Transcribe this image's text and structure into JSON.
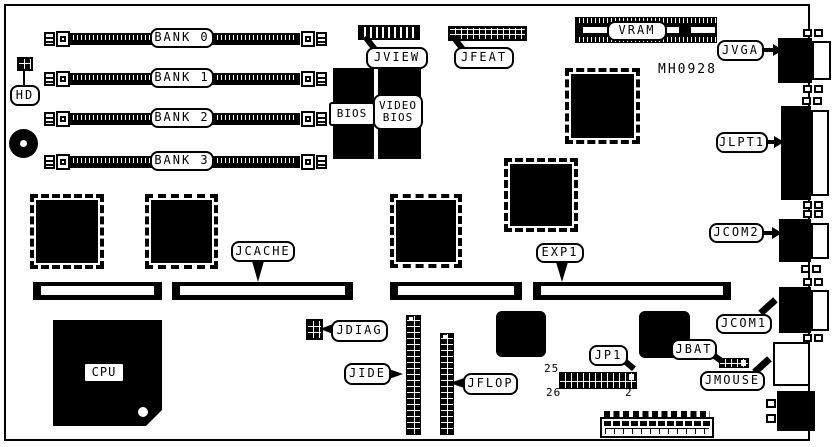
{
  "board": {
    "part_number": "MH0928",
    "memory_banks": [
      {
        "label": "BANK 0"
      },
      {
        "label": "BANK 1"
      },
      {
        "label": "BANK 2"
      },
      {
        "label": "BANK 3"
      }
    ],
    "chips": {
      "cpu": "CPU",
      "bios": "BIOS",
      "video_bios": "VIDEO BIOS",
      "vram": "VRAM"
    },
    "connectors": {
      "hd": "HD",
      "jview": "JVIEW",
      "jfeat": "JFEAT",
      "jvga": "JVGA",
      "jlpt1": "JLPT1",
      "jcom2": "JCOM2",
      "jcom1": "JCOM1",
      "jmouse": "JMOUSE",
      "jbat": "JBAT",
      "jp1": "JP1",
      "jdiag": "JDIAG",
      "jide": "JIDE",
      "jflop": "JFLOP",
      "jcache": "JCACHE",
      "exp1": "EXP1"
    },
    "jp1_pins": {
      "top_left": "25",
      "bottom_left": "26",
      "bottom_right": "2"
    },
    "colors": {
      "ink": "#000000",
      "paper": "#ffffff"
    }
  }
}
